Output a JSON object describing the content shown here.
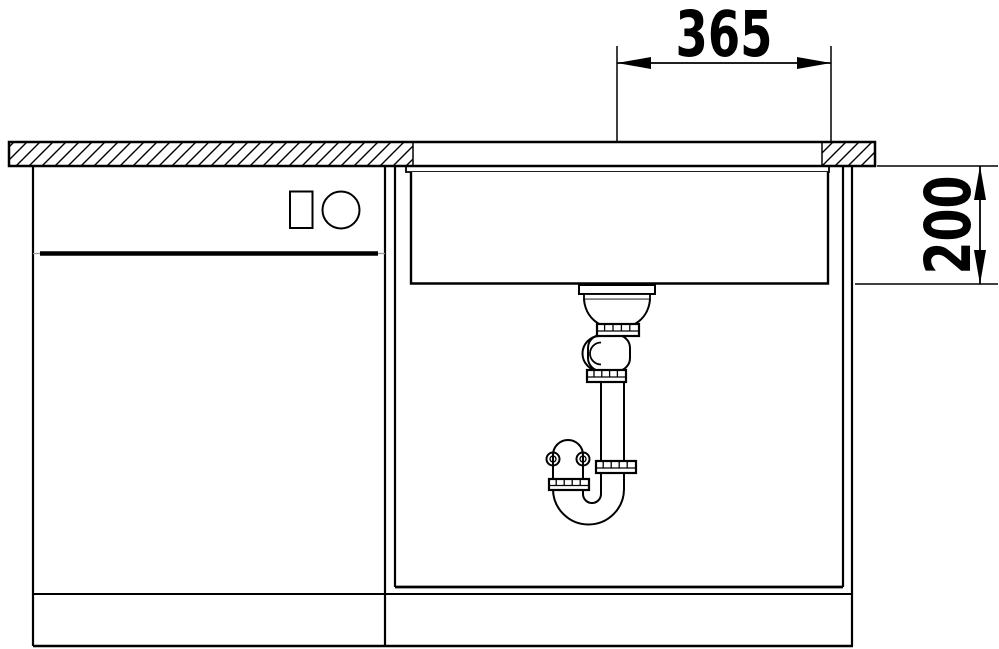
{
  "colors": {
    "background": "#ffffff",
    "line": "#000000"
  },
  "drawing": {
    "width_dimension_label": "365",
    "depth_dimension_label": "200"
  }
}
